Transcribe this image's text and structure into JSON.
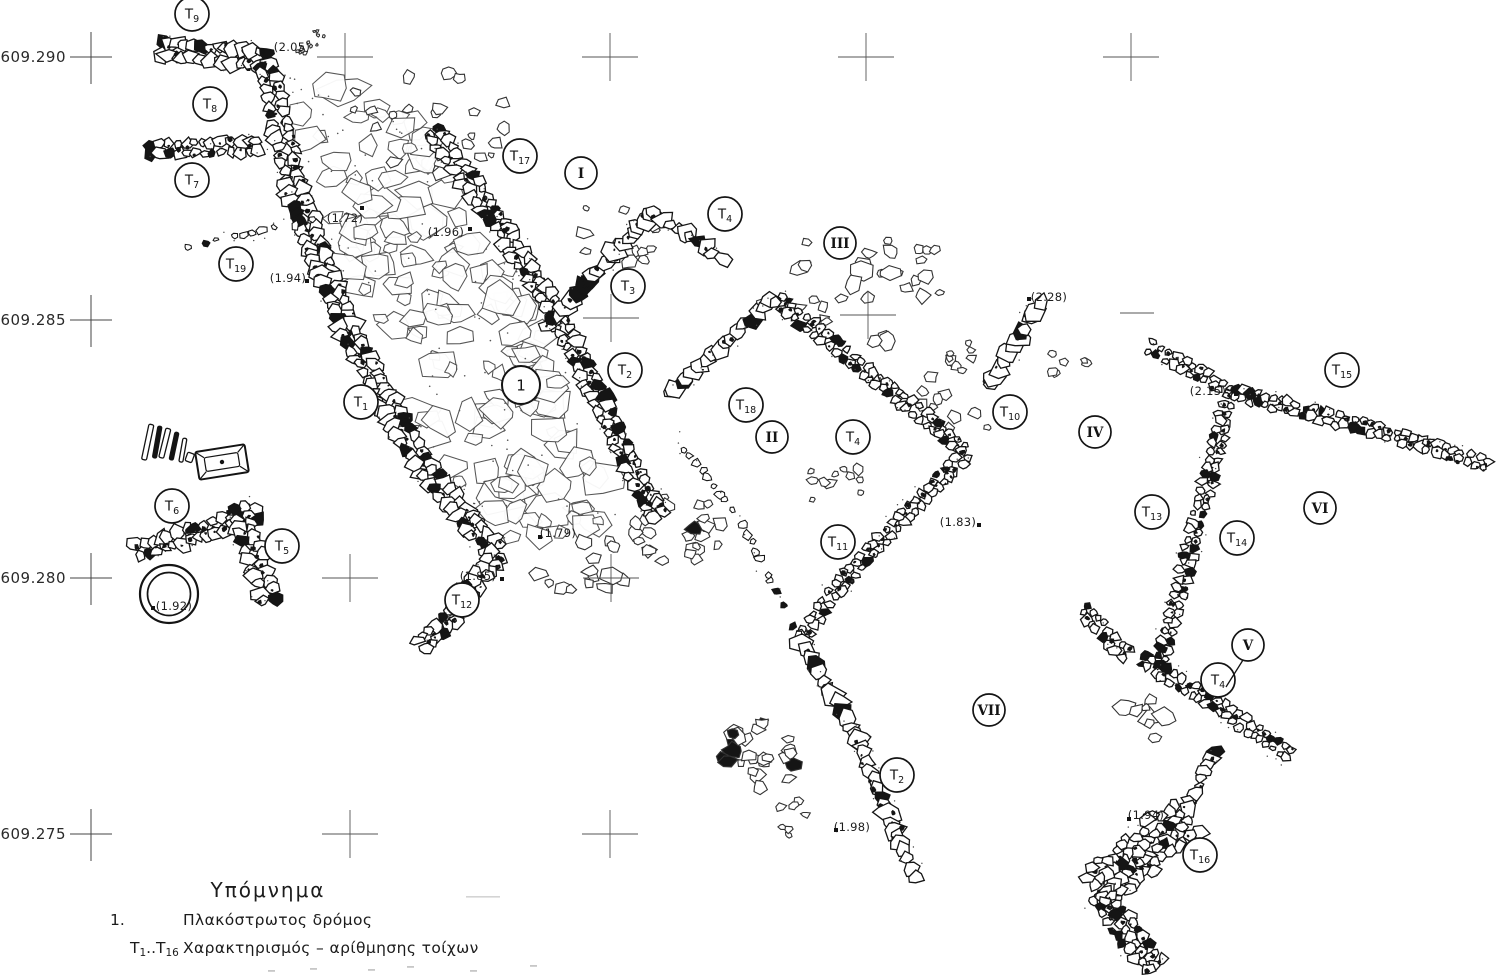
{
  "plan": {
    "type": "archaeological-excavation-plan",
    "grid": {
      "row_labels": [
        {
          "text": "609.290",
          "y": 57
        },
        {
          "text": "609.285",
          "y": 320
        },
        {
          "text": "609.280",
          "y": 578
        },
        {
          "text": "609.275",
          "y": 834
        }
      ],
      "crosses": [
        [
          345,
          57
        ],
        [
          610,
          57
        ],
        [
          866,
          57
        ],
        [
          1131,
          57
        ],
        [
          611,
          318
        ],
        [
          868,
          315
        ],
        [
          350,
          578
        ],
        [
          611,
          578
        ],
        [
          350,
          834
        ],
        [
          610,
          834
        ]
      ],
      "dash_marks": [
        [
          1137,
          313
        ]
      ]
    },
    "wall_markers": [
      {
        "id": "T9",
        "x": 192,
        "y": 14
      },
      {
        "id": "T8",
        "x": 210,
        "y": 104
      },
      {
        "id": "T7",
        "x": 192,
        "y": 180
      },
      {
        "id": "T19",
        "x": 236,
        "y": 264
      },
      {
        "id": "T17",
        "x": 520,
        "y": 156
      },
      {
        "id": "T4",
        "x": 725,
        "y": 214
      },
      {
        "id": "T3",
        "x": 628,
        "y": 286
      },
      {
        "id": "T2",
        "x": 625,
        "y": 370
      },
      {
        "id": "T1",
        "x": 361,
        "y": 402
      },
      {
        "id": "T18",
        "x": 746,
        "y": 405
      },
      {
        "id": "T4",
        "x": 853,
        "y": 437
      },
      {
        "id": "T10",
        "x": 1010,
        "y": 412
      },
      {
        "id": "T13",
        "x": 1152,
        "y": 512
      },
      {
        "id": "T14",
        "x": 1237,
        "y": 538
      },
      {
        "id": "T15",
        "x": 1342,
        "y": 370
      },
      {
        "id": "T6",
        "x": 172,
        "y": 506
      },
      {
        "id": "T5",
        "x": 282,
        "y": 546
      },
      {
        "id": "T11",
        "x": 838,
        "y": 542
      },
      {
        "id": "T12",
        "x": 462,
        "y": 600
      },
      {
        "id": "T4",
        "x": 1218,
        "y": 680
      },
      {
        "id": "T2",
        "x": 897,
        "y": 775
      },
      {
        "id": "T16",
        "x": 1200,
        "y": 855
      }
    ],
    "area_markers": [
      {
        "id": "I",
        "x": 581,
        "y": 173
      },
      {
        "id": "III",
        "x": 840,
        "y": 243
      },
      {
        "id": "II",
        "x": 772,
        "y": 437
      },
      {
        "id": "IV",
        "x": 1095,
        "y": 432
      },
      {
        "id": "VI",
        "x": 1320,
        "y": 508
      },
      {
        "id": "V",
        "x": 1248,
        "y": 645
      },
      {
        "id": "VII",
        "x": 989,
        "y": 710
      }
    ],
    "road_marker": {
      "id": "1",
      "x": 521,
      "y": 385
    },
    "elevations": [
      {
        "text": "(2.05)",
        "x": 292,
        "y": 47,
        "dot": [
          263,
          52
        ]
      },
      {
        "text": "(1.72)",
        "x": 345,
        "y": 218,
        "dot": [
          362,
          208
        ]
      },
      {
        "text": "(1.96)",
        "x": 446,
        "y": 232,
        "dot": [
          470,
          229
        ]
      },
      {
        "text": "(1.94)",
        "x": 288,
        "y": 278,
        "dot": [
          307,
          281
        ]
      },
      {
        "text": "(2.28)",
        "x": 1049,
        "y": 297,
        "dot": [
          1029,
          299
        ]
      },
      {
        "text": "(2.15)",
        "x": 1208,
        "y": 391,
        "dot": [
          1236,
          394
        ]
      },
      {
        "text": "(1.79)",
        "x": 558,
        "y": 533,
        "dot": [
          540,
          537
        ]
      },
      {
        "text": "(1.85)",
        "x": 478,
        "y": 576,
        "dot": [
          502,
          579
        ]
      },
      {
        "text": "(1.83)",
        "x": 958,
        "y": 522,
        "dot": [
          979,
          525
        ]
      },
      {
        "text": "(1.92)",
        "x": 174,
        "y": 606,
        "dot": [
          153,
          608
        ]
      },
      {
        "text": "(1.98)",
        "x": 852,
        "y": 827,
        "dot": [
          836,
          830
        ]
      },
      {
        "text": "(1.94)",
        "x": 1146,
        "y": 815,
        "dot": [
          1129,
          819
        ]
      }
    ],
    "legend": {
      "title": "Υπόμνημα",
      "items": [
        {
          "key": "1.",
          "text": "Πλακόστρωτος  δρόμος"
        },
        {
          "key": "T1..T16",
          "text": "Χαρακτηρισμός – αρίθμησης  τοίχων"
        }
      ]
    }
  }
}
